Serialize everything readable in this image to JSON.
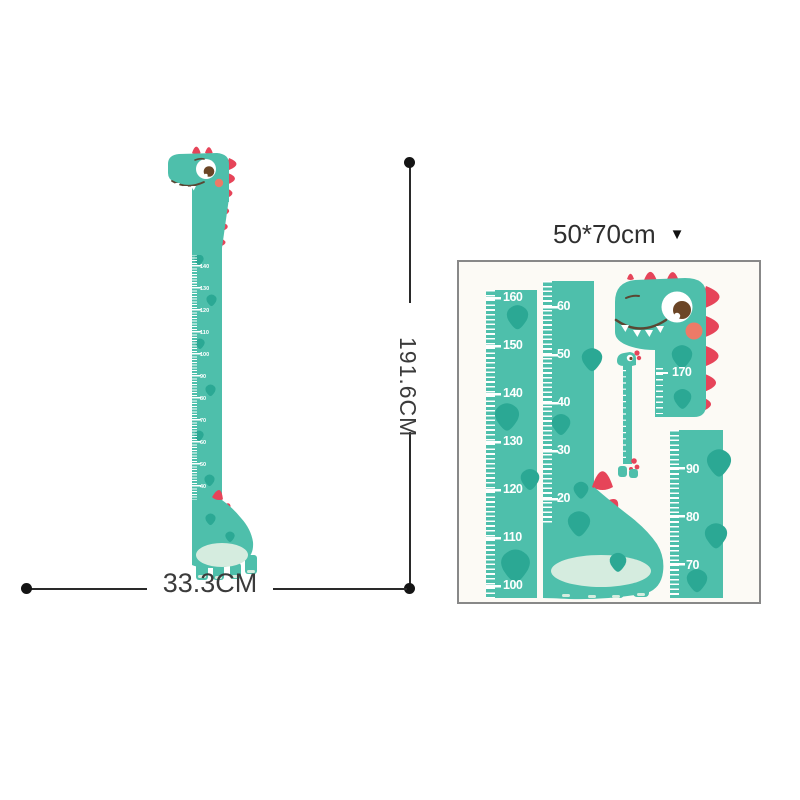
{
  "size_selector": {
    "label": "50*70cm",
    "dropdown_icon": "▼"
  },
  "dimensions": {
    "height_label": "191.6CM",
    "width_label": "33.3CM"
  },
  "assembled_chart": {
    "ruler_numbers": [
      "170",
      "160",
      "150",
      "140",
      "130",
      "120",
      "110",
      "100",
      "90",
      "80",
      "70",
      "60",
      "50",
      "40",
      "30",
      "20"
    ]
  },
  "sticker_sheet": {
    "strip_left": {
      "numbers": [
        "160",
        "150",
        "140",
        "130",
        "120",
        "110",
        "100"
      ]
    },
    "strip_middle": {
      "numbers": [
        "60",
        "50",
        "40",
        "30",
        "20",
        "10"
      ]
    },
    "strip_right": {
      "numbers": [
        "90",
        "80",
        "70"
      ]
    },
    "head_piece_number": "170"
  },
  "colors": {
    "teal": "#4ebfab",
    "teal_dark": "#2ba894",
    "red": "#e64459",
    "cheek": "#ed7a67",
    "belly": "#d5ecdf",
    "dimension_line": "#2a2a2a"
  }
}
